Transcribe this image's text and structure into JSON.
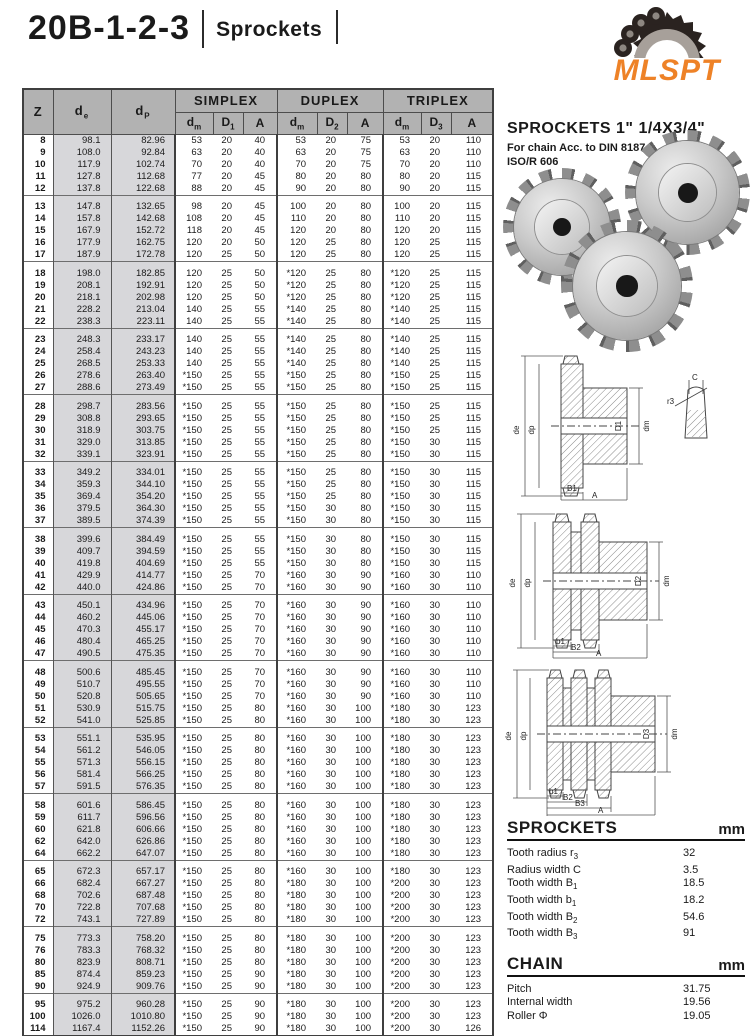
{
  "header": {
    "title": "20B-1-2-3",
    "subtitle": "Sprockets",
    "logo_text": "MLSPT"
  },
  "colors": {
    "accent_orange": "#EE8227",
    "table_header_gray": "#B2B2B2",
    "shaded_col_gray": "#D7D7DA"
  },
  "right": {
    "heading": "SPROCKETS 1\" 1/4X3/4\"",
    "subheading1": "For chain Acc. to DIN 8187",
    "subheading2": "ISO/R 606",
    "sprockets_spec": {
      "title": "SPROCKETS",
      "unit": "mm",
      "rows": [
        {
          "label": "Tooth radius r",
          "sub": "3",
          "value": "32"
        },
        {
          "label": "Radius width C",
          "sub": "",
          "value": "3.5"
        },
        {
          "label": "Tooth width B",
          "sub": "1",
          "value": "18.5"
        },
        {
          "label": "Tooth width b",
          "sub": "1",
          "value": "18.2"
        },
        {
          "label": "Tooth width B",
          "sub": "2",
          "value": "54.6"
        },
        {
          "label": "Tooth width B",
          "sub": "3",
          "value": "91"
        }
      ]
    },
    "chain_spec": {
      "title": "CHAIN",
      "unit": "mm",
      "rows": [
        {
          "label": "Pitch",
          "sub": "",
          "value": "31.75"
        },
        {
          "label": "Internal width",
          "sub": "",
          "value": "19.56"
        },
        {
          "label": "Roller Φ",
          "sub": "",
          "value": "19.05"
        }
      ]
    },
    "material": "Material: C 45",
    "weld_note": "*Weld on hub"
  },
  "drawings": {
    "simplex": {
      "de": "de",
      "dp": "dp",
      "bore": "D1",
      "dm": "dm",
      "w1": "B1",
      "total": "A",
      "detail_c": "C",
      "detail_r": "r3"
    },
    "duplex": {
      "de": "de",
      "dp": "dp",
      "bore": "D2",
      "dm": "dm",
      "w1": "b1",
      "w2": "B2",
      "total": "A"
    },
    "triplex": {
      "de": "de",
      "dp": "dp",
      "bore": "D3",
      "dm": "dm",
      "w1": "b1",
      "w2": "B2",
      "w3": "B3",
      "total": "A"
    }
  },
  "table": {
    "corner_cols": [
      {
        "base": "Z",
        "sub": ""
      },
      {
        "base": "d",
        "sub": "e"
      },
      {
        "base": "d",
        "sub": "P"
      }
    ],
    "sections": [
      {
        "label": "SIMPLEX",
        "cols": [
          {
            "base": "d",
            "sub": "m"
          },
          {
            "base": "D",
            "sub": "1"
          },
          {
            "base": "A",
            "sub": ""
          }
        ]
      },
      {
        "label": "DUPLEX",
        "cols": [
          {
            "base": "d",
            "sub": "m"
          },
          {
            "base": "D",
            "sub": "2"
          },
          {
            "base": "A",
            "sub": ""
          }
        ]
      },
      {
        "label": "TRIPLEX",
        "cols": [
          {
            "base": "d",
            "sub": "m"
          },
          {
            "base": "D",
            "sub": "3"
          },
          {
            "base": "A",
            "sub": ""
          }
        ]
      }
    ],
    "groups": [
      [
        [
          "8",
          "98.1",
          "82.96",
          "53",
          "20",
          "40",
          "53",
          "20",
          "75",
          "53",
          "20",
          "110"
        ],
        [
          "9",
          "108.0",
          "92.84",
          "63",
          "20",
          "40",
          "63",
          "20",
          "75",
          "63",
          "20",
          "110"
        ],
        [
          "10",
          "117.9",
          "102.74",
          "70",
          "20",
          "40",
          "70",
          "20",
          "75",
          "70",
          "20",
          "110"
        ],
        [
          "11",
          "127.8",
          "112.68",
          "77",
          "20",
          "45",
          "80",
          "20",
          "80",
          "80",
          "20",
          "115"
        ],
        [
          "12",
          "137.8",
          "122.68",
          "88",
          "20",
          "45",
          "90",
          "20",
          "80",
          "90",
          "20",
          "115"
        ]
      ],
      [
        [
          "13",
          "147.8",
          "132.65",
          "98",
          "20",
          "45",
          "100",
          "20",
          "80",
          "100",
          "20",
          "115"
        ],
        [
          "14",
          "157.8",
          "142.68",
          "108",
          "20",
          "45",
          "110",
          "20",
          "80",
          "110",
          "20",
          "115"
        ],
        [
          "15",
          "167.9",
          "152.72",
          "118",
          "20",
          "45",
          "120",
          "20",
          "80",
          "120",
          "20",
          "115"
        ],
        [
          "16",
          "177.9",
          "162.75",
          "120",
          "20",
          "50",
          "120",
          "25",
          "80",
          "120",
          "25",
          "115"
        ],
        [
          "17",
          "187.9",
          "172.78",
          "120",
          "25",
          "50",
          "120",
          "25",
          "80",
          "120",
          "25",
          "115"
        ]
      ],
      [
        [
          "18",
          "198.0",
          "182.85",
          "120",
          "25",
          "50",
          "*120",
          "25",
          "80",
          "*120",
          "25",
          "115"
        ],
        [
          "19",
          "208.1",
          "192.91",
          "120",
          "25",
          "50",
          "*120",
          "25",
          "80",
          "*120",
          "25",
          "115"
        ],
        [
          "20",
          "218.1",
          "202.98",
          "120",
          "25",
          "50",
          "*120",
          "25",
          "80",
          "*120",
          "25",
          "115"
        ],
        [
          "21",
          "228.2",
          "213.04",
          "140",
          "25",
          "55",
          "*140",
          "25",
          "80",
          "*140",
          "25",
          "115"
        ],
        [
          "22",
          "238.3",
          "223.11",
          "140",
          "25",
          "55",
          "*140",
          "25",
          "80",
          "*140",
          "25",
          "115"
        ]
      ],
      [
        [
          "23",
          "248.3",
          "233.17",
          "140",
          "25",
          "55",
          "*140",
          "25",
          "80",
          "*140",
          "25",
          "115"
        ],
        [
          "24",
          "258.4",
          "243.23",
          "140",
          "25",
          "55",
          "*140",
          "25",
          "80",
          "*140",
          "25",
          "115"
        ],
        [
          "25",
          "268.5",
          "253.33",
          "140",
          "25",
          "55",
          "*140",
          "25",
          "80",
          "*140",
          "25",
          "115"
        ],
        [
          "26",
          "278.6",
          "263.40",
          "*150",
          "25",
          "55",
          "*150",
          "25",
          "80",
          "*150",
          "25",
          "115"
        ],
        [
          "27",
          "288.6",
          "273.49",
          "*150",
          "25",
          "55",
          "*150",
          "25",
          "80",
          "*150",
          "25",
          "115"
        ]
      ],
      [
        [
          "28",
          "298.7",
          "283.56",
          "*150",
          "25",
          "55",
          "*150",
          "25",
          "80",
          "*150",
          "25",
          "115"
        ],
        [
          "29",
          "308.8",
          "293.65",
          "*150",
          "25",
          "55",
          "*150",
          "25",
          "80",
          "*150",
          "25",
          "115"
        ],
        [
          "30",
          "318.9",
          "303.75",
          "*150",
          "25",
          "55",
          "*150",
          "25",
          "80",
          "*150",
          "25",
          "115"
        ],
        [
          "31",
          "329.0",
          "313.85",
          "*150",
          "25",
          "55",
          "*150",
          "25",
          "80",
          "*150",
          "30",
          "115"
        ],
        [
          "32",
          "339.1",
          "323.91",
          "*150",
          "25",
          "55",
          "*150",
          "25",
          "80",
          "*150",
          "30",
          "115"
        ]
      ],
      [
        [
          "33",
          "349.2",
          "334.01",
          "*150",
          "25",
          "55",
          "*150",
          "25",
          "80",
          "*150",
          "30",
          "115"
        ],
        [
          "34",
          "359.3",
          "344.10",
          "*150",
          "25",
          "55",
          "*150",
          "25",
          "80",
          "*150",
          "30",
          "115"
        ],
        [
          "35",
          "369.4",
          "354.20",
          "*150",
          "25",
          "55",
          "*150",
          "25",
          "80",
          "*150",
          "30",
          "115"
        ],
        [
          "36",
          "379.5",
          "364.30",
          "*150",
          "25",
          "55",
          "*150",
          "30",
          "80",
          "*150",
          "30",
          "115"
        ],
        [
          "37",
          "389.5",
          "374.39",
          "*150",
          "25",
          "55",
          "*150",
          "30",
          "80",
          "*150",
          "30",
          "115"
        ]
      ],
      [
        [
          "38",
          "399.6",
          "384.49",
          "*150",
          "25",
          "55",
          "*150",
          "30",
          "80",
          "*150",
          "30",
          "115"
        ],
        [
          "39",
          "409.7",
          "394.59",
          "*150",
          "25",
          "55",
          "*150",
          "30",
          "80",
          "*150",
          "30",
          "115"
        ],
        [
          "40",
          "419.8",
          "404.69",
          "*150",
          "25",
          "55",
          "*150",
          "30",
          "80",
          "*150",
          "30",
          "115"
        ],
        [
          "41",
          "429.9",
          "414.77",
          "*150",
          "25",
          "70",
          "*160",
          "30",
          "90",
          "*160",
          "30",
          "110"
        ],
        [
          "42",
          "440.0",
          "424.86",
          "*150",
          "25",
          "70",
          "*160",
          "30",
          "90",
          "*160",
          "30",
          "110"
        ]
      ],
      [
        [
          "43",
          "450.1",
          "434.96",
          "*150",
          "25",
          "70",
          "*160",
          "30",
          "90",
          "*160",
          "30",
          "110"
        ],
        [
          "44",
          "460.2",
          "445.06",
          "*150",
          "25",
          "70",
          "*160",
          "30",
          "90",
          "*160",
          "30",
          "110"
        ],
        [
          "45",
          "470.3",
          "455.17",
          "*150",
          "25",
          "70",
          "*160",
          "30",
          "90",
          "*160",
          "30",
          "110"
        ],
        [
          "46",
          "480.4",
          "465.25",
          "*150",
          "25",
          "70",
          "*160",
          "30",
          "90",
          "*160",
          "30",
          "110"
        ],
        [
          "47",
          "490.5",
          "475.35",
          "*150",
          "25",
          "70",
          "*160",
          "30",
          "90",
          "*160",
          "30",
          "110"
        ]
      ],
      [
        [
          "48",
          "500.6",
          "485.45",
          "*150",
          "25",
          "70",
          "*160",
          "30",
          "90",
          "*160",
          "30",
          "110"
        ],
        [
          "49",
          "510.7",
          "495.55",
          "*150",
          "25",
          "70",
          "*160",
          "30",
          "90",
          "*160",
          "30",
          "110"
        ],
        [
          "50",
          "520.8",
          "505.65",
          "*150",
          "25",
          "70",
          "*160",
          "30",
          "90",
          "*160",
          "30",
          "110"
        ],
        [
          "51",
          "530.9",
          "515.75",
          "*150",
          "25",
          "80",
          "*160",
          "30",
          "100",
          "*180",
          "30",
          "123"
        ],
        [
          "52",
          "541.0",
          "525.85",
          "*150",
          "25",
          "80",
          "*160",
          "30",
          "100",
          "*180",
          "30",
          "123"
        ]
      ],
      [
        [
          "53",
          "551.1",
          "535.95",
          "*150",
          "25",
          "80",
          "*160",
          "30",
          "100",
          "*180",
          "30",
          "123"
        ],
        [
          "54",
          "561.2",
          "546.05",
          "*150",
          "25",
          "80",
          "*160",
          "30",
          "100",
          "*180",
          "30",
          "123"
        ],
        [
          "55",
          "571.3",
          "556.15",
          "*150",
          "25",
          "80",
          "*160",
          "30",
          "100",
          "*180",
          "30",
          "123"
        ],
        [
          "56",
          "581.4",
          "566.25",
          "*150",
          "25",
          "80",
          "*160",
          "30",
          "100",
          "*180",
          "30",
          "123"
        ],
        [
          "57",
          "591.5",
          "576.35",
          "*150",
          "25",
          "80",
          "*160",
          "30",
          "100",
          "*180",
          "30",
          "123"
        ]
      ],
      [
        [
          "58",
          "601.6",
          "586.45",
          "*150",
          "25",
          "80",
          "*160",
          "30",
          "100",
          "*180",
          "30",
          "123"
        ],
        [
          "59",
          "611.7",
          "596.56",
          "*150",
          "25",
          "80",
          "*160",
          "30",
          "100",
          "*180",
          "30",
          "123"
        ],
        [
          "60",
          "621.8",
          "606.66",
          "*150",
          "25",
          "80",
          "*160",
          "30",
          "100",
          "*180",
          "30",
          "123"
        ],
        [
          "62",
          "642.0",
          "626.86",
          "*150",
          "25",
          "80",
          "*160",
          "30",
          "100",
          "*180",
          "30",
          "123"
        ],
        [
          "64",
          "662.2",
          "647.07",
          "*150",
          "25",
          "80",
          "*160",
          "30",
          "100",
          "*180",
          "30",
          "123"
        ]
      ],
      [
        [
          "65",
          "672.3",
          "657.17",
          "*150",
          "25",
          "80",
          "*160",
          "30",
          "100",
          "*180",
          "30",
          "123"
        ],
        [
          "66",
          "682.4",
          "667.27",
          "*150",
          "25",
          "80",
          "*180",
          "30",
          "100",
          "*200",
          "30",
          "123"
        ],
        [
          "68",
          "702.6",
          "687.48",
          "*150",
          "25",
          "80",
          "*180",
          "30",
          "100",
          "*200",
          "30",
          "123"
        ],
        [
          "70",
          "722.8",
          "707.68",
          "*150",
          "25",
          "80",
          "*180",
          "30",
          "100",
          "*200",
          "30",
          "123"
        ],
        [
          "72",
          "743.1",
          "727.89",
          "*150",
          "25",
          "80",
          "*180",
          "30",
          "100",
          "*200",
          "30",
          "123"
        ]
      ],
      [
        [
          "75",
          "773.3",
          "758.20",
          "*150",
          "25",
          "80",
          "*180",
          "30",
          "100",
          "*200",
          "30",
          "123"
        ],
        [
          "76",
          "783.3",
          "768.32",
          "*150",
          "25",
          "80",
          "*180",
          "30",
          "100",
          "*200",
          "30",
          "123"
        ],
        [
          "80",
          "823.9",
          "808.71",
          "*150",
          "25",
          "80",
          "*180",
          "30",
          "100",
          "*200",
          "30",
          "123"
        ],
        [
          "85",
          "874.4",
          "859.23",
          "*150",
          "25",
          "90",
          "*180",
          "30",
          "100",
          "*200",
          "30",
          "123"
        ],
        [
          "90",
          "924.9",
          "909.76",
          "*150",
          "25",
          "90",
          "*180",
          "30",
          "100",
          "*200",
          "30",
          "123"
        ]
      ],
      [
        [
          "95",
          "975.2",
          "960.28",
          "*150",
          "25",
          "90",
          "*180",
          "30",
          "100",
          "*200",
          "30",
          "123"
        ],
        [
          "100",
          "1026.0",
          "1010.80",
          "*150",
          "25",
          "90",
          "*180",
          "30",
          "100",
          "*200",
          "30",
          "123"
        ],
        [
          "114",
          "1167.4",
          "1152.26",
          "*150",
          "25",
          "90",
          "*180",
          "30",
          "100",
          "*200",
          "30",
          "126"
        ]
      ]
    ]
  }
}
